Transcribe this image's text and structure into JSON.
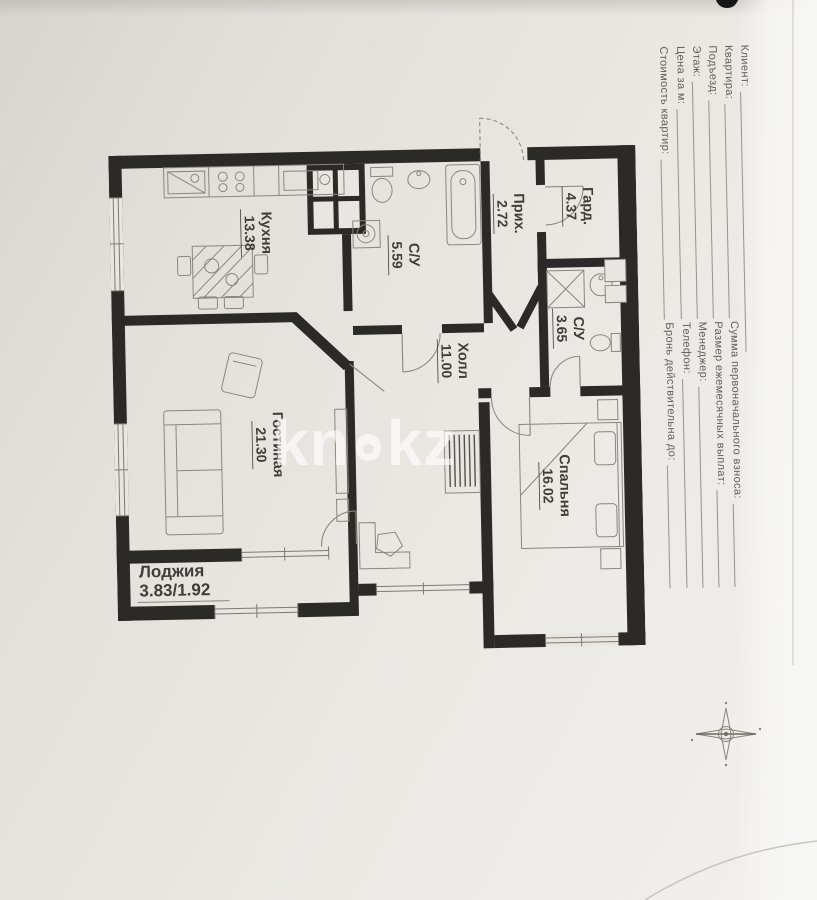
{
  "form": {
    "lines": [
      {
        "label": "Клиент:",
        "label2": ""
      },
      {
        "label": "Квартира:",
        "label2": "Сумма первоначального взноса:"
      },
      {
        "label": "Подъезд:",
        "label2": "Размер ежемесячных выплат:"
      },
      {
        "label": "Этаж:",
        "label2": "Менеджер:"
      },
      {
        "label": "Цена за м:",
        "label2": "Телефон:"
      },
      {
        "label": "Стоимость квартир:",
        "label2": "Бронь действительна до:"
      }
    ]
  },
  "floorplan": {
    "rooms": [
      {
        "name": "Кухня",
        "area": "13.38"
      },
      {
        "name": "С/У",
        "area": "5.59"
      },
      {
        "name": "Прих.",
        "area": "2.72"
      },
      {
        "name": "Гард.",
        "area": "4.37"
      },
      {
        "name": "С/У",
        "area": "3.65"
      },
      {
        "name": "Холл",
        "area": "11.00"
      },
      {
        "name": "Гостиная",
        "area": "21.30"
      },
      {
        "name": "Спальня",
        "area": "16.02"
      },
      {
        "name": "Лоджия",
        "area": "3.83/1.92"
      }
    ]
  },
  "watermark": {
    "left": "kn",
    "right": "kz"
  },
  "colors": {
    "paper": "#e9e6e1",
    "wall": "#2b2a27",
    "furniture_line": "#8a867f",
    "label_text": "#403d39"
  }
}
